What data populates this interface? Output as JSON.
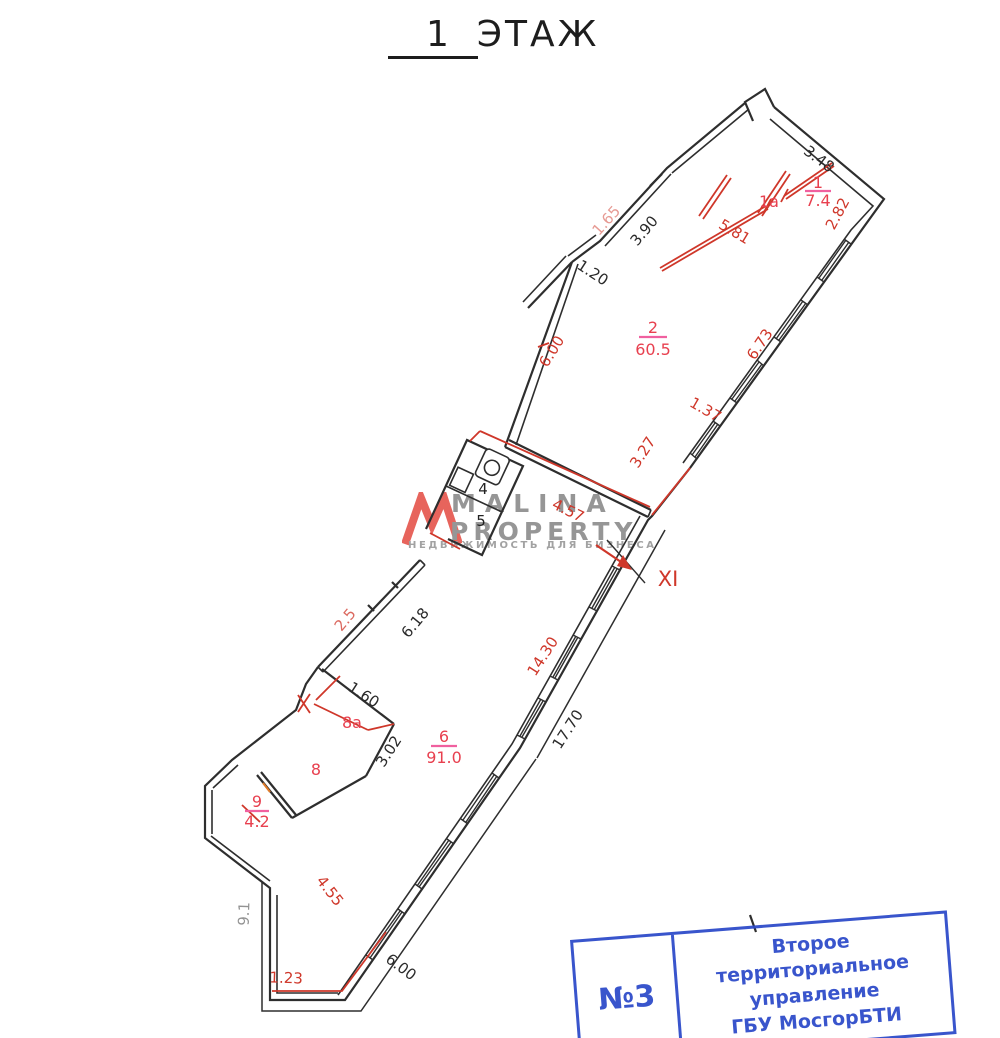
{
  "title": {
    "number": "1",
    "word": "ЭТАЖ"
  },
  "watermark": {
    "brand_line1": "MALINA",
    "brand_line2": "PROPERTY",
    "tagline": "НЕДВИЖИМОСТЬ ДЛЯ БИЗНЕСА",
    "logo_color": "#e0392e",
    "text_color": "#969696"
  },
  "stamp": {
    "number": "№3",
    "org_line1": "Второе территориальное",
    "org_line2": "управление",
    "org_line3": "ГБУ МосгорБТИ",
    "color": "#2b49c9"
  },
  "plan": {
    "entrance_label": "XI",
    "rooms": {
      "r1": {
        "num": "1",
        "area": "7.4"
      },
      "r1a": {
        "num": "1а"
      },
      "r2": {
        "num": "2",
        "area": "60.5"
      },
      "r4": {
        "num": "4"
      },
      "r5": {
        "num": "5"
      },
      "r6": {
        "num": "6",
        "area": "91.0"
      },
      "r8": {
        "num": "8"
      },
      "r8a": {
        "num": "8а"
      },
      "r9": {
        "num": "9",
        "area": "4.2"
      }
    },
    "dims": {
      "d348": "3.48",
      "d390": "3.90",
      "d120": "1.20",
      "d160": "1.60",
      "d302": "3.02",
      "d618": "6.18",
      "d1770": "17.70",
      "d600_bottom": "6.00",
      "d282": "2.82",
      "d581": "5.81",
      "d673": "6.73",
      "d137": "1.37",
      "d327": "3.27",
      "d457": "4.57",
      "d600_left": "6.00",
      "d1430": "14.30",
      "d455": "4.55",
      "d123": "1.23",
      "faint_top": "1.65",
      "faint_left": "2.5",
      "faint_bottom_left": "9.1"
    },
    "colors": {
      "wall_black": "#2e2e2e",
      "partition_red": "#cf372a",
      "label_pink_underline": "#f0609f",
      "room_label_red": "#e8404f"
    }
  }
}
